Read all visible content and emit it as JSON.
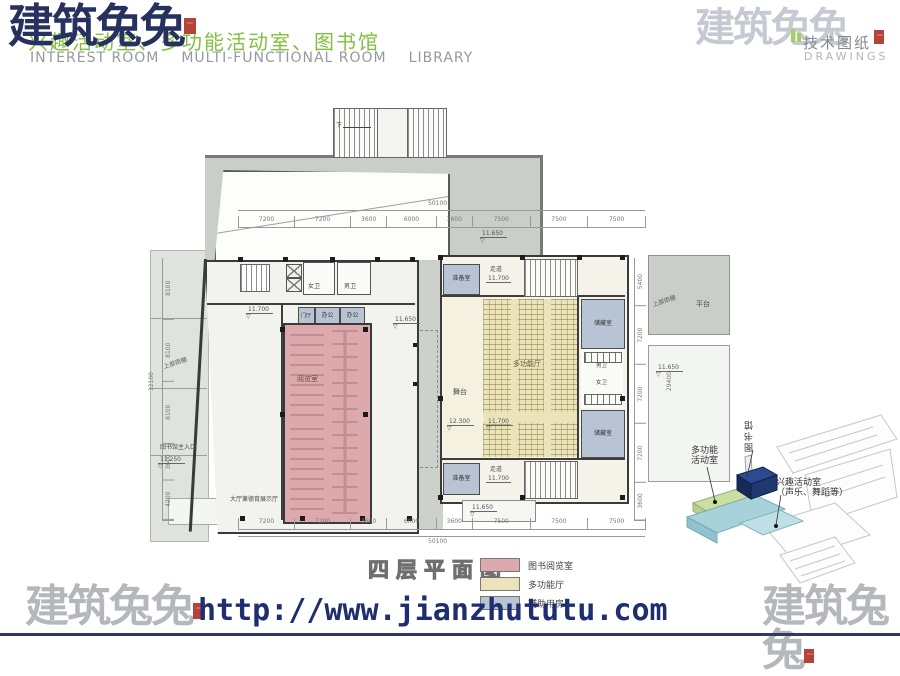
{
  "header": {
    "logo_text": "建筑兔兔",
    "subtitle_cn": "兴趣活动室、多功能活动室、图书馆",
    "subtitle_en_terms": [
      "INTEREST ROOM",
      "MULTI-FUNCTIONAL ROOM",
      "LIBRARY"
    ],
    "right_logo_text": "建筑兔兔",
    "right_label_cn": "技术图纸",
    "right_label_en": "DRAWINGS"
  },
  "plan": {
    "title": "四层平面图",
    "labels": {
      "platform_top": "平台",
      "platform_right": "平台",
      "reading_room": "阅览室",
      "hall": "大厅兼德育展示厅",
      "entrance": "图书馆主入口",
      "canopy_left": "上部雨棚",
      "canopy_right": "上部雨棚",
      "lobby": "门厅",
      "office_1": "办公",
      "office_2": "办公",
      "toilet_w": "女卫",
      "toilet_m": "男卫",
      "prep_top": "准备室",
      "prep_bottom": "准备室",
      "corridor_top": "走道",
      "corridor_bottom": "走道",
      "stage": "舞台",
      "multi_hall": "多功能厅",
      "storage_1": "储藏室",
      "storage_2": "储藏室",
      "toilet_m2": "男卫",
      "toilet_w2": "女卫",
      "stair_down": "下"
    },
    "elevations": {
      "courtyard": "11.650",
      "hall": "11.700",
      "entrance": "11.250",
      "top": "11.650",
      "stage": "12.300",
      "seats": "11.700",
      "bottom": "11.650",
      "terrace": "11.650",
      "corridor_top": "11.700",
      "corridor_bottom": "11.700"
    }
  },
  "dimensions": {
    "top": {
      "total": "50100",
      "segments": [
        "7200",
        "7200",
        "3600",
        "6000",
        "3600",
        "7500",
        "7500",
        "7500"
      ]
    },
    "bottom": {
      "total": "50100",
      "segments": [
        "7200",
        "7200",
        "3600",
        "6000",
        "3600",
        "7500",
        "7500",
        "7500"
      ]
    },
    "left": {
      "total": "32100",
      "segments": [
        "8100",
        "8100",
        "8100",
        "3600",
        "4200"
      ]
    },
    "right": {
      "total": "29400",
      "segments": [
        "5400",
        "7200",
        "7200",
        "7200",
        "3600"
      ]
    }
  },
  "legend": {
    "items": [
      {
        "label": "图书阅览室",
        "color": "#dcaaac"
      },
      {
        "label": "多功能厅",
        "color": "#ebe4ba"
      },
      {
        "label": "辅助用房",
        "color": "#b8c4d4"
      }
    ]
  },
  "key_diagram": {
    "multi_line1": "多功能",
    "multi_line2": "活动室",
    "library": "图书馆",
    "interest_line1": "兴趣活动室",
    "interest_line2": "（声乐、舞蹈等）"
  },
  "footer": {
    "url": "http://www.jianzhututu.com",
    "logo_left": "建筑兔兔",
    "logo_right": "建筑兔兔"
  },
  "colors": {
    "reading_room": "#dcaaac",
    "multi_hall": "#ebe4ba",
    "auxiliary": "#b8c4d4",
    "platform": "#c9cfc8",
    "logo_navy": "#26315f",
    "brand_green": "#82c13e",
    "url_blue": "#1e2e6e",
    "seal_red": "#b5433a"
  }
}
